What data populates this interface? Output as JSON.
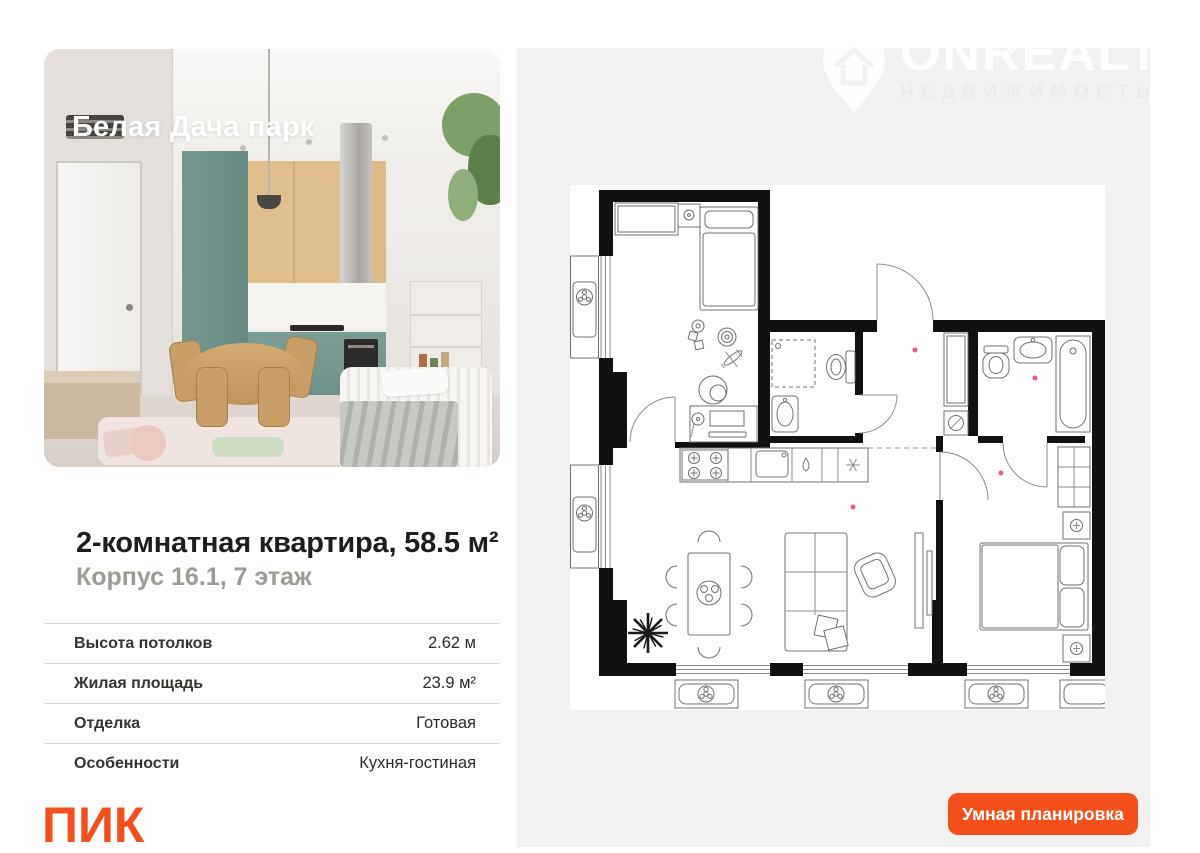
{
  "photo_card": {
    "project_name": "Белая Дача парк"
  },
  "watermark": {
    "brand": "ONREALT",
    "tagline": "НЕДВИЖИМОСТЬ"
  },
  "listing": {
    "title": "2-комнатная квартира, 58.5 м²",
    "subtitle": "Корпус 16.1, 7 этаж",
    "specs": [
      {
        "label": "Высота потолков",
        "value": "2.62 м"
      },
      {
        "label": "Жилая площадь",
        "value": "23.9 м²"
      },
      {
        "label": "Отделка",
        "value": "Готовая"
      },
      {
        "label": "Особенности",
        "value": "Кухня-гостиная"
      }
    ]
  },
  "developer": {
    "logo_text": "ПИК"
  },
  "plan": {
    "smart_button": "Умная планировка"
  },
  "colors": {
    "accent": "#F4501C",
    "panel_gray": "#F2F1EF",
    "wall_black": "#111111",
    "pink_dot": "#EE5A8F"
  }
}
